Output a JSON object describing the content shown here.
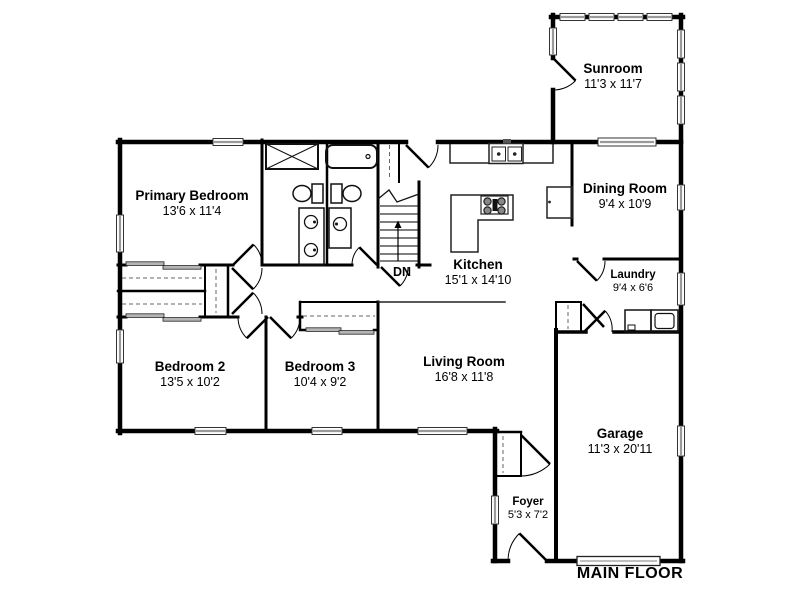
{
  "plan": {
    "title": "MAIN FLOOR",
    "stairs": {
      "label": "DN"
    },
    "rooms": [
      {
        "id": "primary-bedroom",
        "name": "Primary Bedroom",
        "dims": "13'6 x 11'4"
      },
      {
        "id": "sunroom",
        "name": "Sunroom",
        "dims": "11'3 x 11'7"
      },
      {
        "id": "dining-room",
        "name": "Dining Room",
        "dims": "9'4 x 10'9"
      },
      {
        "id": "kitchen",
        "name": "Kitchen",
        "dims": "15'1 x 14'10"
      },
      {
        "id": "laundry",
        "name": "Laundry",
        "dims": "9'4 x 6'6"
      },
      {
        "id": "bedroom-2",
        "name": "Bedroom 2",
        "dims": "13'5 x 10'2"
      },
      {
        "id": "bedroom-3",
        "name": "Bedroom 3",
        "dims": "10'4 x 9'2"
      },
      {
        "id": "living-room",
        "name": "Living Room",
        "dims": "16'8 x 11'8"
      },
      {
        "id": "garage",
        "name": "Garage",
        "dims": "11'3 x 20'11"
      },
      {
        "id": "foyer",
        "name": "Foyer",
        "dims": "5'3 x 7'2"
      }
    ],
    "colors": {
      "wall": "#000000",
      "background": "#ffffff",
      "window_bar": "#9a9a9a",
      "closet_door": "#b5b5b5",
      "dashed_line": "#666666"
    }
  }
}
